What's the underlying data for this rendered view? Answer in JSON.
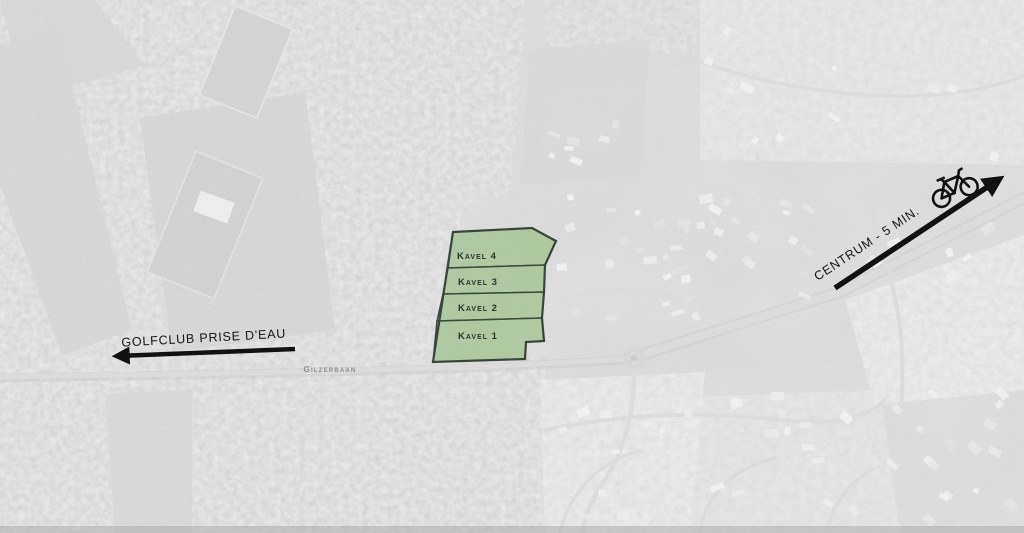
{
  "parcels": {
    "fill_color": "#abc79d",
    "outline_color": "#3c4a3e",
    "items": [
      {
        "id": "kavel-4",
        "label": "Kavel 4"
      },
      {
        "id": "kavel-3",
        "label": "Kavel 3"
      },
      {
        "id": "kavel-2",
        "label": "Kavel 2"
      },
      {
        "id": "kavel-1",
        "label": "Kavel 1"
      }
    ]
  },
  "annotations": {
    "arrow_color": "#111111",
    "golfclub": {
      "label": "GOLFCLUB PRISE D'EAU",
      "direction": "left"
    },
    "centrum": {
      "label": "CENTRUM - 5 MIN.",
      "direction": "upper-right",
      "icon": "bicycle-icon"
    },
    "street": {
      "label": "Gilzerbaan"
    }
  }
}
